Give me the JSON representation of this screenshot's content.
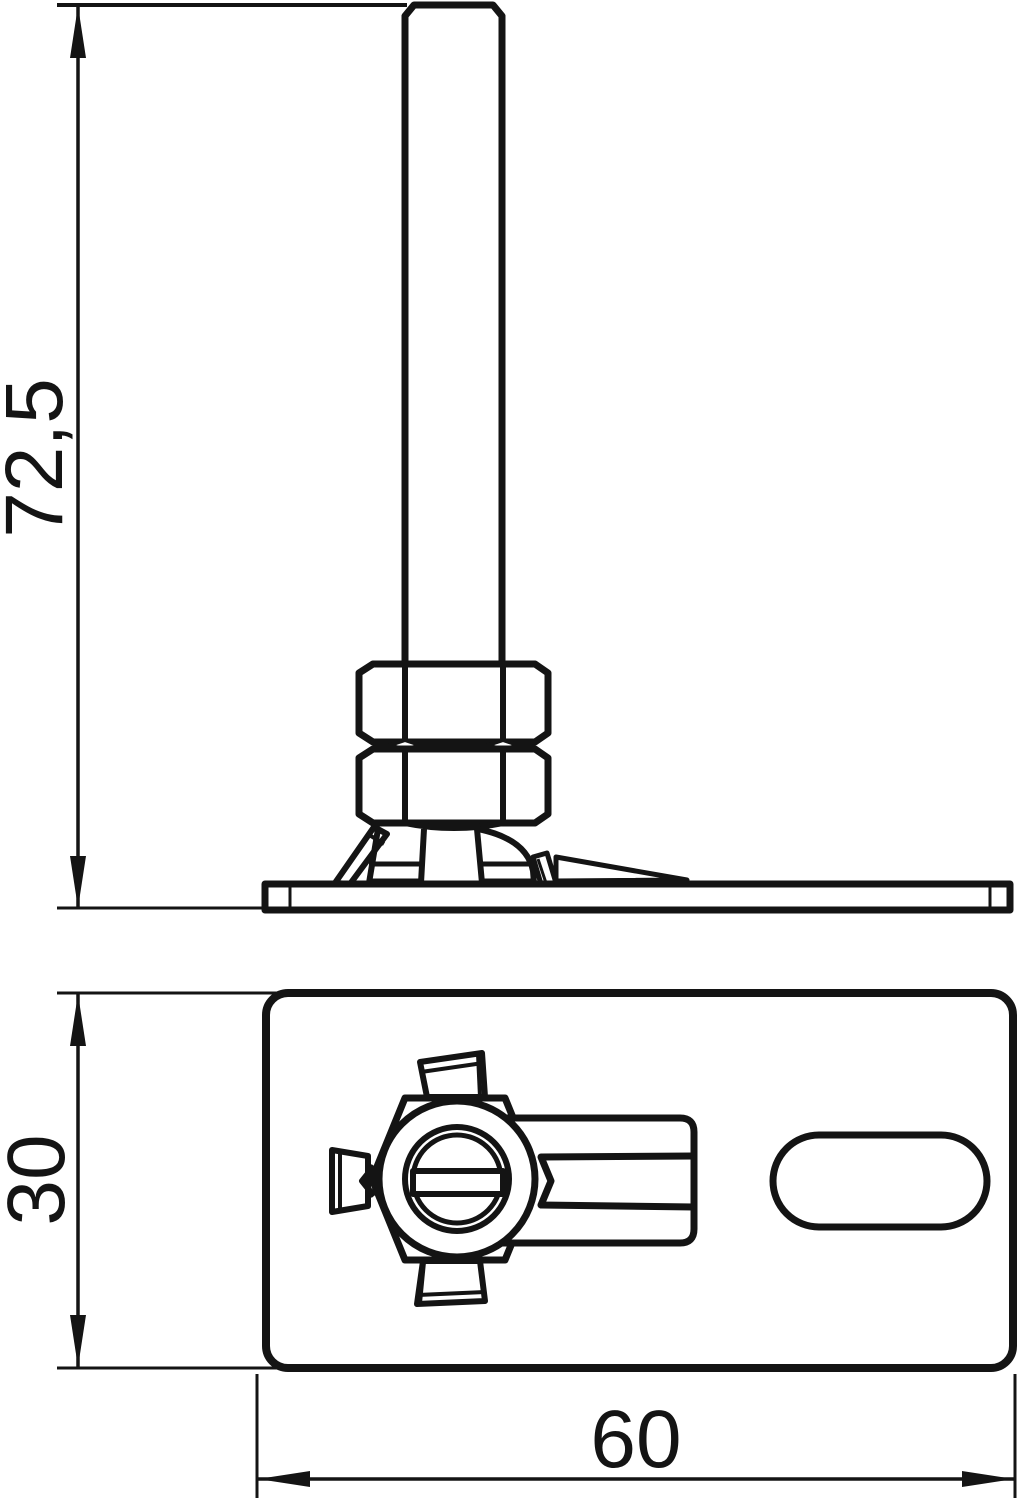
{
  "drawing": {
    "kind": "technical-drawing-two-views",
    "dimensions": {
      "overall_height": "72,5",
      "plate_width": "30",
      "plate_length": "60"
    },
    "colors": {
      "line": "#141414",
      "background": "#ffffff"
    }
  }
}
